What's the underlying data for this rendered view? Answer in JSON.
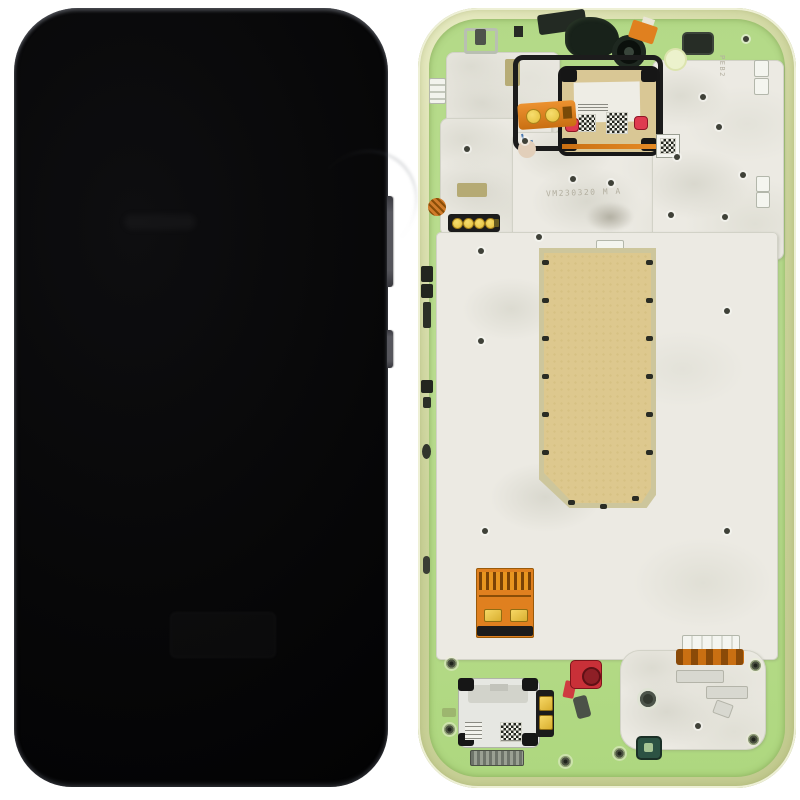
{
  "scene": {
    "etched_marking_mid": "VM230320 M A",
    "etched_marking_corner": "PEB2"
  },
  "colors": {
    "frame-lime": "#ccd49b",
    "plastic-green": "#bde093",
    "metal": "#eceae3",
    "thermal-tan": "#ddc88e",
    "thermal-border": "#cdc69c",
    "flex-orange": "#e0801f",
    "flex-orange-dark": "#c96f12",
    "contact-gold": "#e9c84a",
    "gasket-red": "#df3b50",
    "motor-red": "#c93038",
    "flex-black": "#1c1c1c",
    "screen-black": "#070708",
    "mic-teal": "#2c5243"
  }
}
